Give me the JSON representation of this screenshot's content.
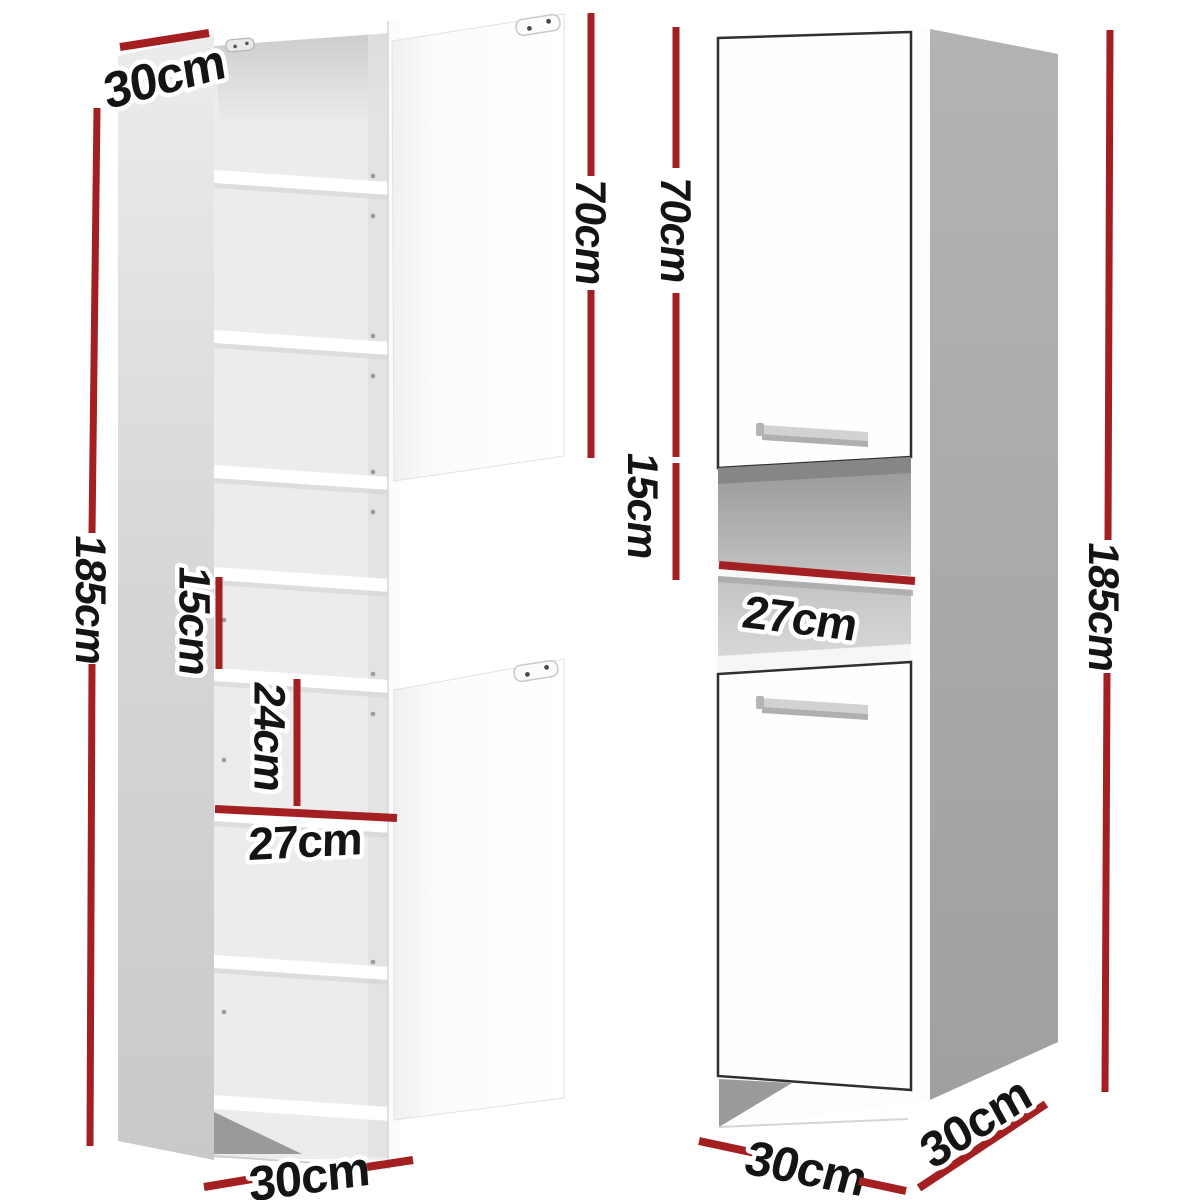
{
  "figure": {
    "description": "Two views of a tall white bathroom storage cabinet with red dimension annotations",
    "colors": {
      "dimension_line": "#a31f21",
      "label_text": "#141414",
      "label_outline": "#ffffff",
      "left_side_panel": "#d6d6d6",
      "right_side_panel": "#a9a9a9",
      "door_outline": "#2f2f2f",
      "background": "#ffffff"
    },
    "left_view": {
      "name": "open-cabinet-view",
      "dims": {
        "top_depth": "30cm",
        "height_total": "185cm",
        "door_height": "70cm",
        "gap_small": "15cm",
        "gap_medium": "24cm",
        "inner_width": "27cm",
        "base_width": "30cm"
      }
    },
    "right_view": {
      "name": "closed-cabinet-view",
      "dims": {
        "door_height": "70cm",
        "niche_height": "15cm",
        "niche_width": "27cm",
        "height_total": "185cm",
        "base_width": "30cm",
        "base_depth": "30cm"
      }
    }
  }
}
